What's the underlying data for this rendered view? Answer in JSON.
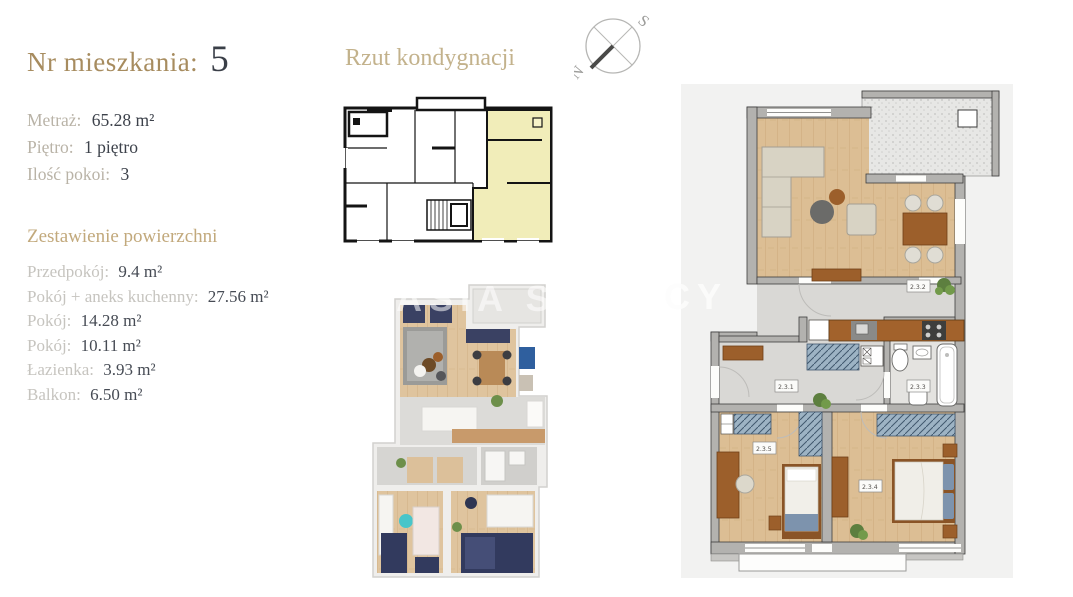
{
  "apartment": {
    "title_label": "Nr mieszkania:",
    "title_number": "5",
    "details": [
      {
        "label": "Metraż:",
        "value": "65.28 m²"
      },
      {
        "label": "Piętro:",
        "value": "1 piętro"
      },
      {
        "label": "Ilość pokoi:",
        "value": "3"
      }
    ],
    "areas_heading": "Zestawienie powierzchni",
    "areas": [
      {
        "label": "Przedpokój:",
        "value": "9.4 m²"
      },
      {
        "label": "Pokój + aneks kuchenny:",
        "value": "27.56 m²"
      },
      {
        "label": "Pokój:",
        "value": "14.28 m²"
      },
      {
        "label": "Pokój:",
        "value": "10.11  m²"
      },
      {
        "label": "Łazienka:",
        "value": "3.93 m²"
      },
      {
        "label": "Balkon:",
        "value": "6.50 m²"
      }
    ]
  },
  "floor_section": {
    "heading": "Rzut kondygnacji",
    "compass": {
      "south": "S",
      "north": "N"
    }
  },
  "detail_plan": {
    "labels": {
      "hall": "2.3.1",
      "living": "2.3.2",
      "bathroom": "2.3.3",
      "bedroom_main": "2.3.4",
      "bedroom_second": "2.3.5"
    }
  },
  "watermark": {
    "left_fragment": "ASIA S",
    "right_fragment": "CY"
  },
  "colors": {
    "accent_gold": "#a78c5f",
    "heading_tan": "#c3b28c",
    "dark_text": "#3a3f48",
    "label_gray": "#c6c4bf",
    "highlight_yellow": "#f1edb9",
    "panel_gray": "#f2f2f1",
    "wall_gray": "#b3b2af",
    "wood": "#dcbe94",
    "furniture_brown": "#9c5f2b",
    "wardrobe_blue": "#9db3c4",
    "bed_navy": "#3a4163"
  }
}
